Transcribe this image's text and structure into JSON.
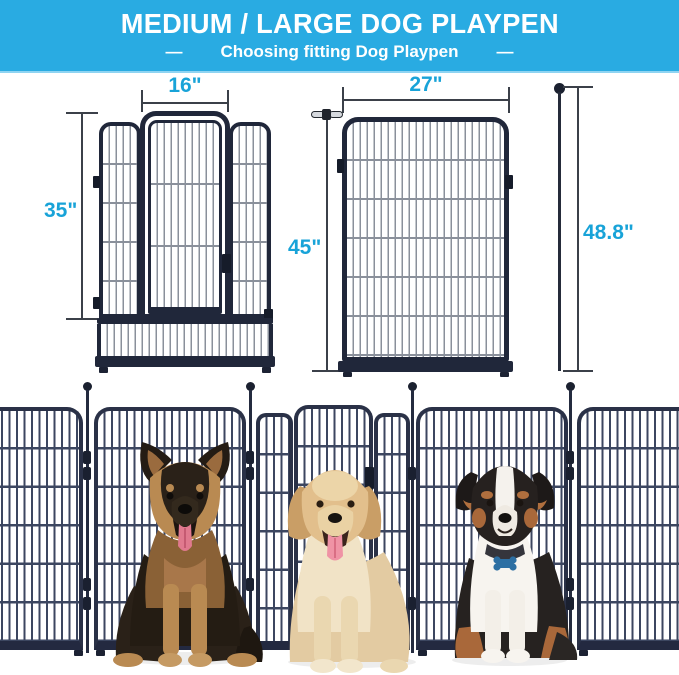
{
  "header": {
    "title": "MEDIUM / LARGE DOG PLAYPEN",
    "dash": "—",
    "subtitle": "Choosing fitting Dog Playpen",
    "bg_color": "#29abe2",
    "text_color": "#ffffff"
  },
  "diagrams": {
    "accent_color": "#18a3d8",
    "frame_color": "#20273a",
    "door_panel": {
      "width_label": "16\"",
      "height_label": "35\""
    },
    "large_panel": {
      "width_label": "27\"",
      "height_label": "45\"",
      "rod_height_label": "48.8\""
    }
  },
  "photo": {
    "fence_color": "#2a3147",
    "dogs": [
      {
        "name": "german-shepherd"
      },
      {
        "name": "golden-retriever"
      },
      {
        "name": "australian-shepherd"
      }
    ]
  }
}
